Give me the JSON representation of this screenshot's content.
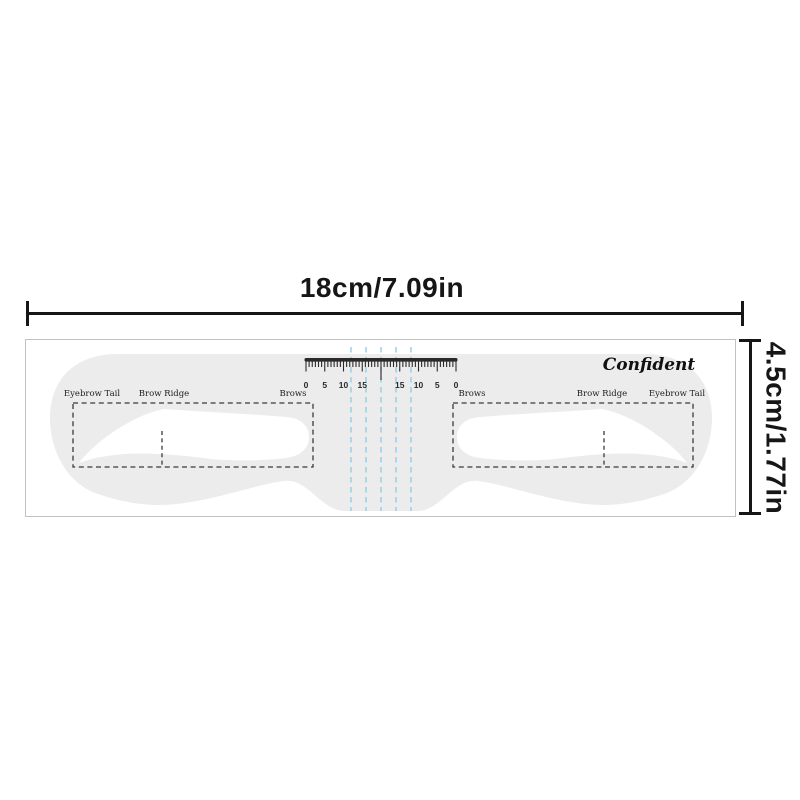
{
  "dimensions": {
    "width_label": "18cm/7.09in",
    "height_label": "4.5cm/1.77in"
  },
  "stencil": {
    "brand": "Confident",
    "regions_left": {
      "tail": "Eyebrow Tail",
      "ridge": "Brow Ridge",
      "brows": "Brows"
    },
    "regions_right": {
      "brows": "Brows",
      "ridge": "Brow Ridge",
      "tail": "Eyebrow Tail"
    },
    "ruler": {
      "numbers": [
        "0",
        "5",
        "10",
        "15",
        "",
        "15",
        "10",
        "5",
        "0"
      ],
      "minor_ticks_per_interval": 6
    },
    "guide_line_count": 5
  },
  "colors": {
    "stencil_fill": "#ececed",
    "outline_dash": "#3a3a3a",
    "ruler_ink": "#2a2a2a",
    "guide_blue": "#96d0e8",
    "dimension_ink": "#161616",
    "sheet_border": "#c2c2c2"
  }
}
